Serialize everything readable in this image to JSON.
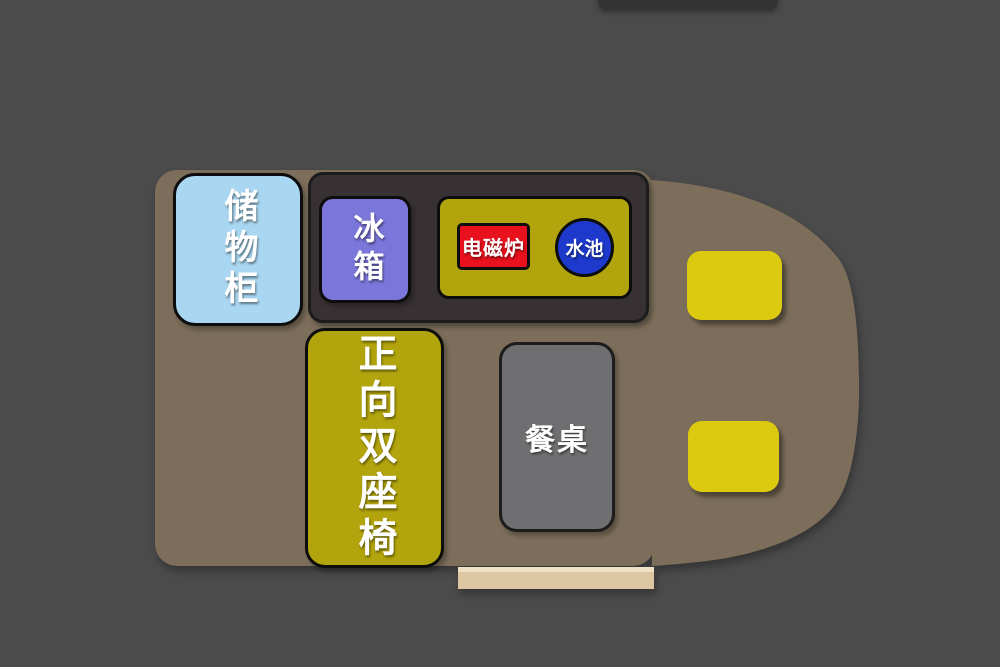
{
  "floorplan": {
    "labels": {
      "storage_cabinet": "储物柜",
      "fridge": "冰箱",
      "induction_cooker": "电磁炉",
      "sink": "水池",
      "forward_double_seat": "正向双座椅",
      "dining_table": "餐桌"
    },
    "colors": {
      "background": "#4b4b4b",
      "van_body": "#7c6e5a",
      "cabin_panel": "#383134",
      "storage_cabinet": "#a9d6f0",
      "fridge": "#7b76da",
      "counter": "#b2a40c",
      "cooker": "#e8111d",
      "sink": "#1d3acd",
      "forward_seat": "#b2a40c",
      "cab_seat": "#dbca10",
      "dining_table": "#6f6f71",
      "entry_step": "#dcc7a2",
      "entry_step_highlight": "#eee0c2",
      "top_bar": "#333333"
    }
  }
}
